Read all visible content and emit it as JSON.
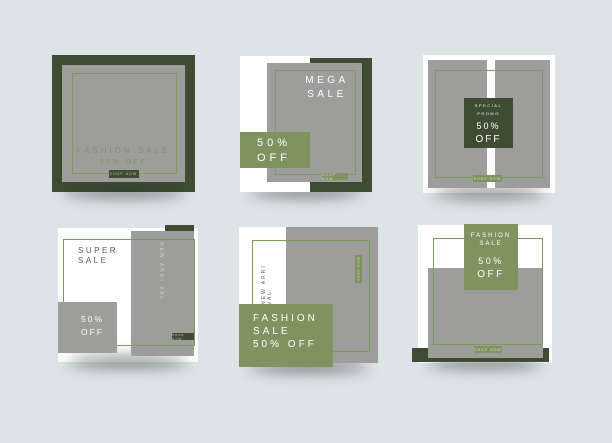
{
  "canvas": {
    "width": 612,
    "height": 443,
    "background": "#dde4e8"
  },
  "palette": {
    "background": "#dde4e8",
    "dark_green": "#3e4d31",
    "olive_green": "#7e9360",
    "rule_line_green": "#7f9b58",
    "panel_gray": "#9d9d9b",
    "card_white": "#ffffff",
    "olive_text": "#7d9a58",
    "dark_text": "#5b6153"
  },
  "cards": [
    {
      "name": "framed-fashion-sale",
      "title": "FASHION SALE",
      "discount": "50% OFF",
      "cta": "SHOP NOW"
    },
    {
      "name": "mega-sale",
      "title_line1": "MEGA",
      "title_line2": "SALE",
      "discount_line1": "50%",
      "discount_line2": "OFF",
      "cta": "SHOP NOW"
    },
    {
      "name": "special-promo",
      "line1": "SPECIAL",
      "line2": "PROMO",
      "line3": "50%",
      "line4": "OFF",
      "cta": "SHOP NOW"
    },
    {
      "name": "super-sale",
      "title_line1": "SUPER",
      "title_line2": "SALE",
      "vertical_label": "NEW ARRI VAL",
      "discount_line1": "50%",
      "discount_line2": "OFF",
      "cta": "SHOP NOW"
    },
    {
      "name": "new-arrival-fashion-sale",
      "vertical_label": "NEW ARRI VAL",
      "vertical_cta": "SHOP NOW",
      "line1": "FASHION",
      "line2": "SALE",
      "line3": "50% OFF"
    },
    {
      "name": "fashion-sale-tag",
      "tag_line1": "FASHION",
      "tag_line2": "SALE",
      "tag_line3": "50%",
      "tag_line4": "OFF",
      "cta": "SHOP NOW"
    }
  ]
}
